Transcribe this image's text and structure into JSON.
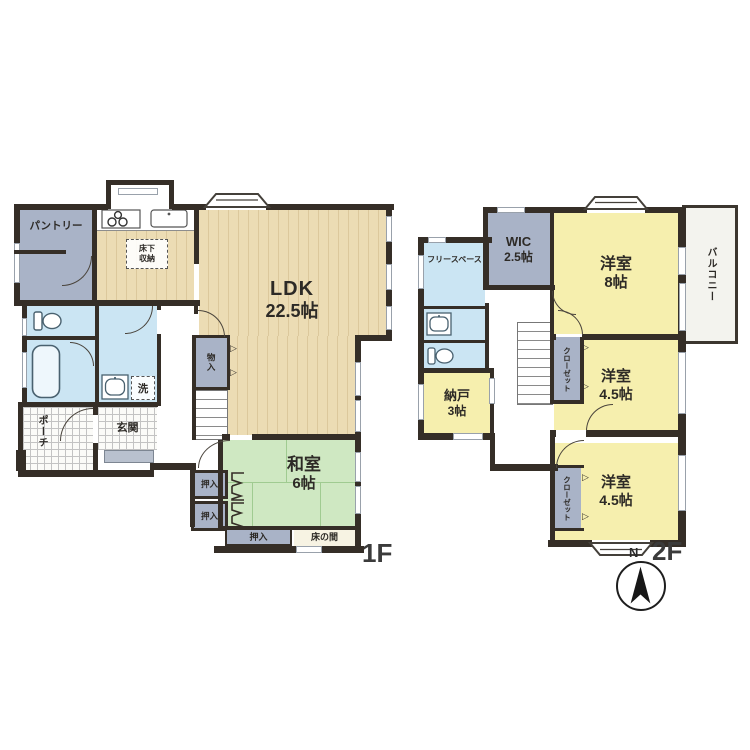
{
  "floor1": {
    "floor_label": "1F",
    "pantry": "パントリー",
    "underfloor_storage": "床下収納",
    "ldk_name": "LDK",
    "ldk_size": "22.5帖",
    "storage_monoire": "物入",
    "laundry": "洗",
    "entrance": "玄関",
    "porch": "ポーチ",
    "japanese_room": "和室",
    "japanese_room_size": "6帖",
    "closet_left_1": "押入",
    "closet_left_2": "押入",
    "closet_bottom": "押入",
    "tokonoma": "床の間"
  },
  "floor2": {
    "floor_label": "2F",
    "wic_name": "WIC",
    "wic_size": "2.5帖",
    "bedroom8_name": "洋室",
    "bedroom8_size": "8帖",
    "balcony": "バルコニー",
    "free_space": "フリースペース",
    "storage_room": "納戸",
    "storage_room_size": "3帖",
    "bedroom45a_name": "洋室",
    "bedroom45a_size": "4.5帖",
    "bedroom45b_name": "洋室",
    "bedroom45b_size": "4.5帖",
    "closet_a": "クローゼット",
    "closet_b": "クローゼット"
  },
  "compass": {
    "north_label": "N"
  },
  "colors": {
    "wall": "#352e27",
    "wood": "#ecdcb4",
    "wood_stripe": "#dcc89c",
    "tatami": "#cfe8c2",
    "tatami_line": "#a0cb91",
    "storage_gray": "#a9b3c7",
    "water_blue": "#cbe5f3",
    "bedroom_yellow": "#f6efae",
    "tile_bg": "#fbfbf8",
    "tile_line": "#c3c3c3",
    "step_gray": "#b9c1ce",
    "balcony_bg": "#f3f3ee",
    "text": "#2d2a26"
  }
}
